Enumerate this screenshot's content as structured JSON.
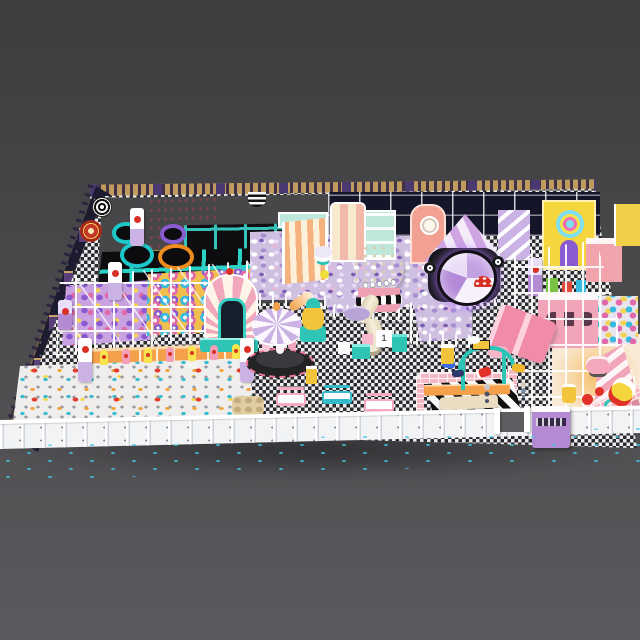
{
  "scene": {
    "subject": "indoor-playground-3d-render",
    "visible_text": {
      "step_block_number": "1"
    },
    "palette": {
      "background_gray_top": "#3d3d3f",
      "background_gray_bottom": "#5b5a5e",
      "wall_navy": "#1c1b30",
      "trim_gold": "#bf9c5e",
      "floor_check_dark": "#2a2a2e",
      "floor_check_light": "#ececee",
      "trampoline_teal": "#2bd3c6",
      "mat_black": "#0d0d10",
      "purple_ball_pit": "#cfc0e2",
      "white_ball_pit": "#efeeec",
      "pink_wall": "#f6aac4",
      "salmon": "#f2a091",
      "yellow": "#f5d63e",
      "orange": "#f5a04a",
      "teal": "#2ec4b6",
      "cream": "#f6ecd8",
      "red": "#d93025",
      "lavender": "#b48ad2",
      "walkway_dot_cyan": "#45c8e8"
    },
    "zones": [
      "back-wall",
      "left-wall",
      "trampoline-court",
      "climbing-wall",
      "round-trampolines",
      "crawl-maze",
      "white-ball-pit",
      "rainbow-arch",
      "carousel",
      "purple-ball-pit",
      "planet-ball-tower",
      "tube-slide",
      "striped-slide",
      "gem-portal",
      "candy-house-facades",
      "yellow-house",
      "right-play-structure",
      "pink-slide",
      "staircase",
      "toy-car-track",
      "zebra-entrance",
      "cafe-tables",
      "toddler-toys",
      "perimeter-fence",
      "entrance-gate",
      "shoe-cabinet",
      "walkway"
    ]
  }
}
